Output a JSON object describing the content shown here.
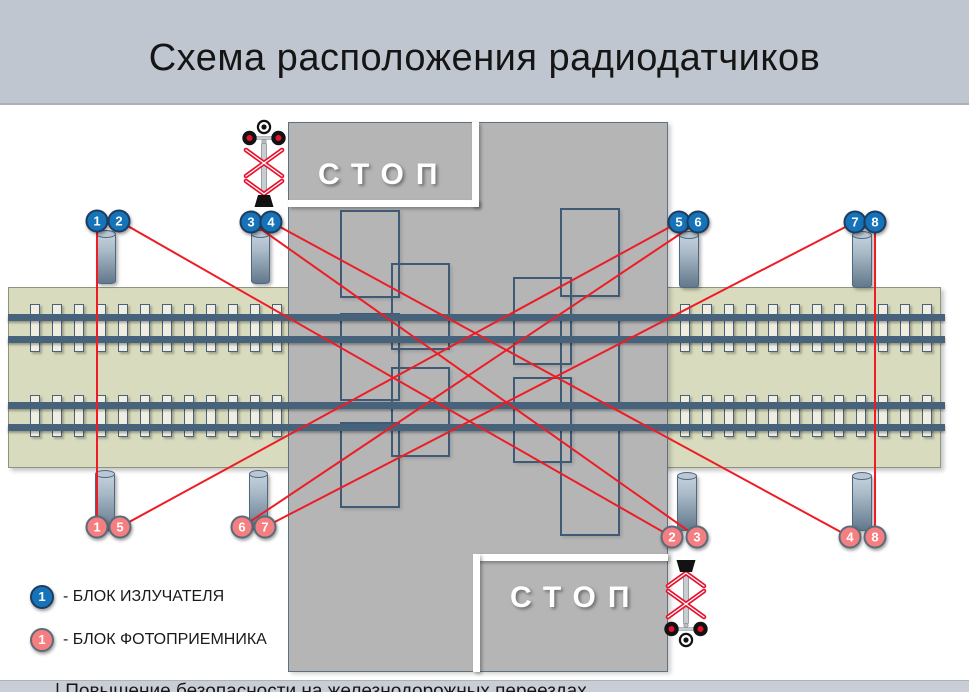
{
  "title": "Схема расположения радиодатчиков",
  "footer_text": "| Повышение безопасности на железнодорожных переездах",
  "road": {
    "stop_top": "СТОП",
    "stop_bottom": "СТОП"
  },
  "legend": {
    "emitter_num": "1",
    "emitter_label": "- БЛОК ИЗЛУЧАТЕЛЯ",
    "receiver_num": "1",
    "receiver_label": "- БЛОК ФОТОПРИЕМНИКА"
  },
  "colors": {
    "emitter": "#1573b9",
    "emitter-border": "#1e3c5e",
    "receiver": "#f57e81",
    "receiver-border": "#5a6b7a",
    "beam": "#ee1c25",
    "rail": "#47637c",
    "tie": "#f1eee1",
    "road": "#b5b5b5",
    "bed": "#d8dbbe",
    "titlebar": "#bfc6cf",
    "footerbar": "#c9ced6"
  },
  "emitters": [
    {
      "label": "1",
      "x": 97,
      "y": 221
    },
    {
      "label": "2",
      "x": 119,
      "y": 221
    },
    {
      "label": "3",
      "x": 251,
      "y": 222
    },
    {
      "label": "4",
      "x": 271,
      "y": 222
    },
    {
      "label": "5",
      "x": 679,
      "y": 222
    },
    {
      "label": "6",
      "x": 698,
      "y": 222
    },
    {
      "label": "7",
      "x": 855,
      "y": 222
    },
    {
      "label": "8",
      "x": 875,
      "y": 222
    }
  ],
  "receivers": [
    {
      "label": "1",
      "x": 97,
      "y": 527
    },
    {
      "label": "5",
      "x": 120,
      "y": 527
    },
    {
      "label": "6",
      "x": 242,
      "y": 527
    },
    {
      "label": "7",
      "x": 265,
      "y": 527
    },
    {
      "label": "2",
      "x": 672,
      "y": 537
    },
    {
      "label": "3",
      "x": 697,
      "y": 537
    },
    {
      "label": "4",
      "x": 850,
      "y": 537
    },
    {
      "label": "8",
      "x": 875,
      "y": 537
    }
  ],
  "beams": [
    [
      97,
      221,
      97,
      527
    ],
    [
      119,
      221,
      672,
      537
    ],
    [
      251,
      222,
      697,
      537
    ],
    [
      271,
      222,
      850,
      537
    ],
    [
      679,
      222,
      120,
      527
    ],
    [
      698,
      222,
      242,
      527
    ],
    [
      855,
      222,
      265,
      527
    ],
    [
      875,
      222,
      875,
      537
    ]
  ],
  "posts": [
    {
      "x": 96,
      "y": 232,
      "w": 18,
      "h": 50
    },
    {
      "x": 251,
      "y": 232,
      "w": 17,
      "h": 50
    },
    {
      "x": 679,
      "y": 233,
      "w": 18,
      "h": 53
    },
    {
      "x": 852,
      "y": 233,
      "w": 18,
      "h": 53
    },
    {
      "x": 95,
      "y": 472,
      "w": 18,
      "h": 57
    },
    {
      "x": 249,
      "y": 472,
      "w": 17,
      "h": 56
    },
    {
      "x": 677,
      "y": 474,
      "w": 18,
      "h": 55
    },
    {
      "x": 852,
      "y": 474,
      "w": 18,
      "h": 55
    }
  ],
  "vehicles": [
    {
      "x": 340,
      "y": 210,
      "w": 60,
      "h": 88
    },
    {
      "x": 340,
      "y": 313,
      "w": 60,
      "h": 88
    },
    {
      "x": 340,
      "y": 422,
      "w": 60,
      "h": 86
    },
    {
      "x": 391,
      "y": 263,
      "w": 59,
      "h": 87
    },
    {
      "x": 391,
      "y": 367,
      "w": 59,
      "h": 90
    },
    {
      "x": 513,
      "y": 277,
      "w": 59,
      "h": 88
    },
    {
      "x": 513,
      "y": 377,
      "w": 59,
      "h": 86
    },
    {
      "x": 560,
      "y": 208,
      "w": 60,
      "h": 89
    },
    {
      "x": 560,
      "y": 317,
      "w": 60,
      "h": 88
    },
    {
      "x": 560,
      "y": 425,
      "w": 60,
      "h": 111
    }
  ],
  "track": {
    "rails": [
      314,
      336,
      402,
      424
    ],
    "rail_x": 8,
    "rail_w": 937,
    "ties": {
      "pitch": 22,
      "width": 10,
      "groups": [
        {
          "x0": 30,
          "count": 12
        },
        {
          "x0": 680,
          "count": 12
        }
      ],
      "rows": [
        {
          "y": 304,
          "h": 48
        },
        {
          "y": 395,
          "h": 42
        }
      ]
    }
  }
}
